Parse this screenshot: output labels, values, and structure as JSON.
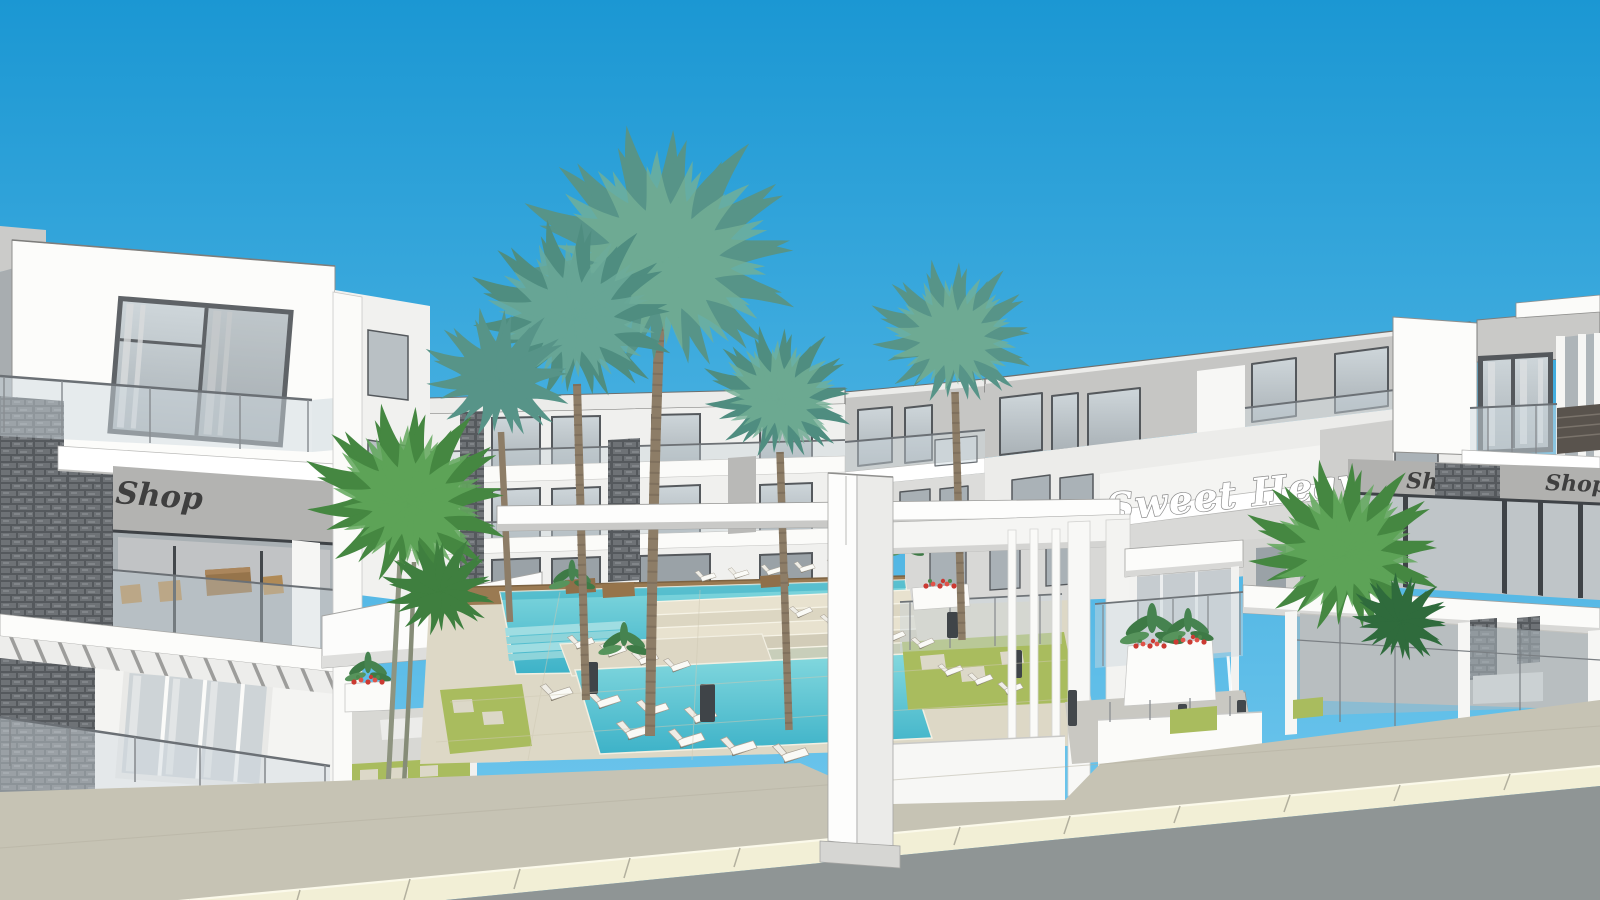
{
  "scene": {
    "type": "3D architectural rendering",
    "description": "Street-level visualization of the Sweet Heaven resort apartment complex: white modern buildings with stone accents, swimming pools with sun loungers, palm trees, shop fronts, an entrance portal and a road with curb in front"
  },
  "signs": {
    "shop_left": "Shop",
    "resort_name": "Sweet Heaven",
    "shop_right_a": "Shop",
    "shop_right_b": "Shop"
  },
  "colors": {
    "sky_top": "#1b97d3",
    "sky_bottom": "#6cc5ec",
    "wall_white": "#fcfcfa",
    "wall_gray": "#c6c6c4",
    "wall_light": "#ececea",
    "glass_light": "#ced6da",
    "glass_dark": "#aab2b7",
    "frame_dark": "#54585c",
    "stone_gray": "#5a5e62",
    "water_light": "#83d8de",
    "water_deep": "#3db2c8",
    "deck_beige": "#ddd8c6",
    "grass_green": "#a9bc5e",
    "palm_teal": "#579488",
    "palm_bright": "#458741",
    "trunk_brown": "#8d7d67",
    "sidewalk": "#c6c3b4",
    "curb_cream": "#f2efd6",
    "asphalt": "#8f9595",
    "sign_dark": "#3f3f3f",
    "sign_white": "#ffffff",
    "wood_brown": "#96744b",
    "flower_red": "#cb3a32"
  }
}
